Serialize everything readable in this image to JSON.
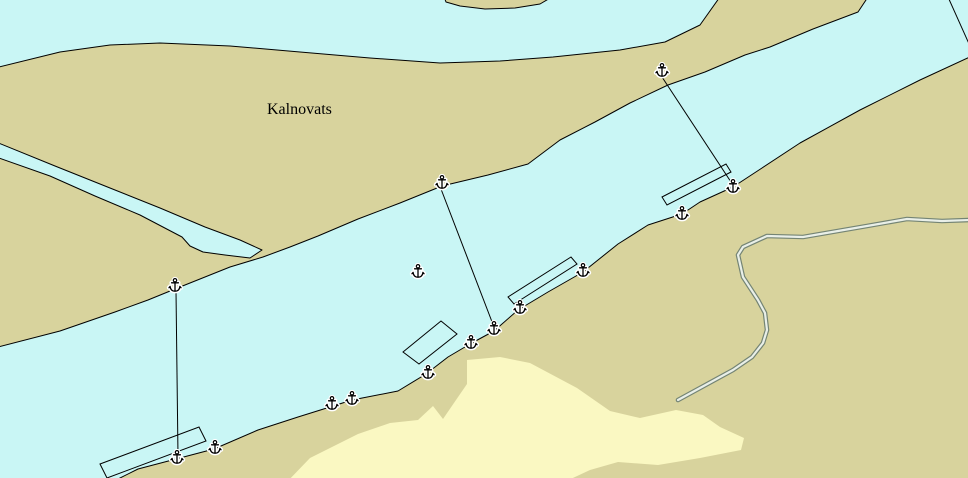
{
  "map": {
    "place_label": "Kalnovats",
    "label_pos": {
      "x": 267,
      "y": 114
    },
    "colors": {
      "water": "#c9f6f5",
      "land": "#d8d39d",
      "shoal": "#faf8c2",
      "outline": "#000000",
      "road_casing": "#748474",
      "road_fill": "#e9efe8",
      "symbol_fill": "#ffffff"
    },
    "symbols": {
      "anchor_count": 15,
      "berth_count": 4,
      "cable_count": 4
    },
    "geometry": {
      "north_island": [
        [
          443,
          -6
        ],
        [
          446,
          2
        ],
        [
          460,
          6
        ],
        [
          485,
          9
        ],
        [
          515,
          8
        ],
        [
          540,
          4
        ],
        [
          557,
          -6
        ]
      ],
      "kalnovats_island": [
        [
          -5,
          68
        ],
        [
          60,
          52
        ],
        [
          110,
          45
        ],
        [
          160,
          43
        ],
        [
          230,
          46
        ],
        [
          300,
          52
        ],
        [
          370,
          58
        ],
        [
          440,
          63
        ],
        [
          500,
          61
        ],
        [
          553,
          57
        ],
        [
          620,
          50
        ],
        [
          665,
          42
        ],
        [
          700,
          25
        ],
        [
          722,
          -6
        ],
        [
          870,
          -6
        ],
        [
          858,
          12
        ],
        [
          813,
          29
        ],
        [
          770,
          47
        ],
        [
          745,
          55
        ],
        [
          705,
          72
        ],
        [
          668,
          85
        ],
        [
          630,
          103
        ],
        [
          595,
          122
        ],
        [
          560,
          140
        ],
        [
          528,
          164
        ],
        [
          488,
          175
        ],
        [
          442,
          186
        ],
        [
          400,
          203
        ],
        [
          358,
          219
        ],
        [
          318,
          236
        ],
        [
          290,
          247
        ],
        [
          263,
          257
        ],
        [
          230,
          267
        ],
        [
          195,
          281
        ],
        [
          175,
          289
        ],
        [
          148,
          300
        ],
        [
          115,
          312
        ],
        [
          60,
          331
        ],
        [
          -6,
          348
        ]
      ],
      "right_bank": [
        [
          974,
          55
        ],
        [
          920,
          80
        ],
        [
          860,
          110
        ],
        [
          800,
          143
        ],
        [
          762,
          168
        ],
        [
          733,
          187
        ],
        [
          700,
          202
        ],
        [
          682,
          214
        ],
        [
          648,
          225
        ],
        [
          618,
          244
        ],
        [
          583,
          272
        ],
        [
          548,
          292
        ],
        [
          518,
          310
        ],
        [
          494,
          331
        ],
        [
          470,
          344
        ],
        [
          448,
          357
        ],
        [
          426,
          374
        ],
        [
          398,
          391
        ],
        [
          352,
          400
        ],
        [
          330,
          407
        ],
        [
          298,
          417
        ],
        [
          258,
          430
        ],
        [
          214,
          449
        ],
        [
          176,
          459
        ],
        [
          138,
          469
        ],
        [
          108,
          484
        ],
        [
          974,
          484
        ]
      ],
      "creek": [
        [
          -4,
          142
        ],
        [
          55,
          166
        ],
        [
          110,
          188
        ],
        [
          160,
          208
        ],
        [
          205,
          227
        ],
        [
          240,
          240
        ],
        [
          262,
          250
        ],
        [
          250,
          258
        ],
        [
          225,
          255
        ],
        [
          203,
          252
        ],
        [
          190,
          246
        ],
        [
          182,
          237
        ],
        [
          140,
          215
        ],
        [
          95,
          196
        ],
        [
          50,
          176
        ],
        [
          -4,
          157
        ]
      ],
      "shoal": [
        [
          285,
          484
        ],
        [
          310,
          458
        ],
        [
          358,
          434
        ],
        [
          390,
          423
        ],
        [
          418,
          420
        ],
        [
          433,
          406
        ],
        [
          443,
          419
        ],
        [
          456,
          400
        ],
        [
          467,
          384
        ],
        [
          467,
          360
        ],
        [
          500,
          357
        ],
        [
          530,
          363
        ],
        [
          577,
          388
        ],
        [
          610,
          411
        ],
        [
          640,
          418
        ],
        [
          676,
          410
        ],
        [
          703,
          415
        ],
        [
          720,
          427
        ],
        [
          744,
          438
        ],
        [
          741,
          450
        ],
        [
          700,
          458
        ],
        [
          658,
          465
        ],
        [
          618,
          462
        ],
        [
          590,
          470
        ],
        [
          560,
          484
        ]
      ],
      "road": [
        [
          678,
          400
        ],
        [
          700,
          388
        ],
        [
          733,
          370
        ],
        [
          752,
          357
        ],
        [
          763,
          343
        ],
        [
          767,
          330
        ],
        [
          765,
          313
        ],
        [
          758,
          300
        ],
        [
          743,
          277
        ],
        [
          738,
          255
        ],
        [
          743,
          247
        ],
        [
          767,
          236
        ],
        [
          803,
          237
        ],
        [
          867,
          226
        ],
        [
          907,
          219
        ],
        [
          942,
          221
        ],
        [
          970,
          220
        ]
      ],
      "berths": [
        [
          [
            100,
            464
          ],
          [
            199,
            427
          ],
          [
            206,
            441
          ],
          [
            107,
            478
          ]
        ],
        [
          [
            403,
            352
          ],
          [
            441,
            321
          ],
          [
            457,
            334
          ],
          [
            419,
            364
          ]
        ],
        [
          [
            508,
            297
          ],
          [
            571,
            257
          ],
          [
            577,
            264
          ],
          [
            514,
            304
          ]
        ],
        [
          [
            662,
            197
          ],
          [
            726,
            164
          ],
          [
            731,
            172
          ],
          [
            667,
            205
          ]
        ]
      ],
      "cables": [
        [
          [
            176,
            291
          ],
          [
            178,
            456
          ]
        ],
        [
          [
            441,
            189
          ],
          [
            494,
            327
          ]
        ],
        [
          [
            662,
            77
          ],
          [
            731,
            182
          ]
        ],
        [
          [
            948,
            -3
          ],
          [
            970,
            46
          ]
        ]
      ],
      "anchors": [
        [
          175,
          285
        ],
        [
          442,
          182
        ],
        [
          418,
          271
        ],
        [
          662,
          70
        ],
        [
          733,
          186
        ],
        [
          682,
          213
        ],
        [
          583,
          270
        ],
        [
          520,
          307
        ],
        [
          494,
          328
        ],
        [
          471,
          342
        ],
        [
          428,
          372
        ],
        [
          352,
          398
        ],
        [
          332,
          403
        ],
        [
          215,
          447
        ],
        [
          177,
          457
        ]
      ]
    }
  }
}
